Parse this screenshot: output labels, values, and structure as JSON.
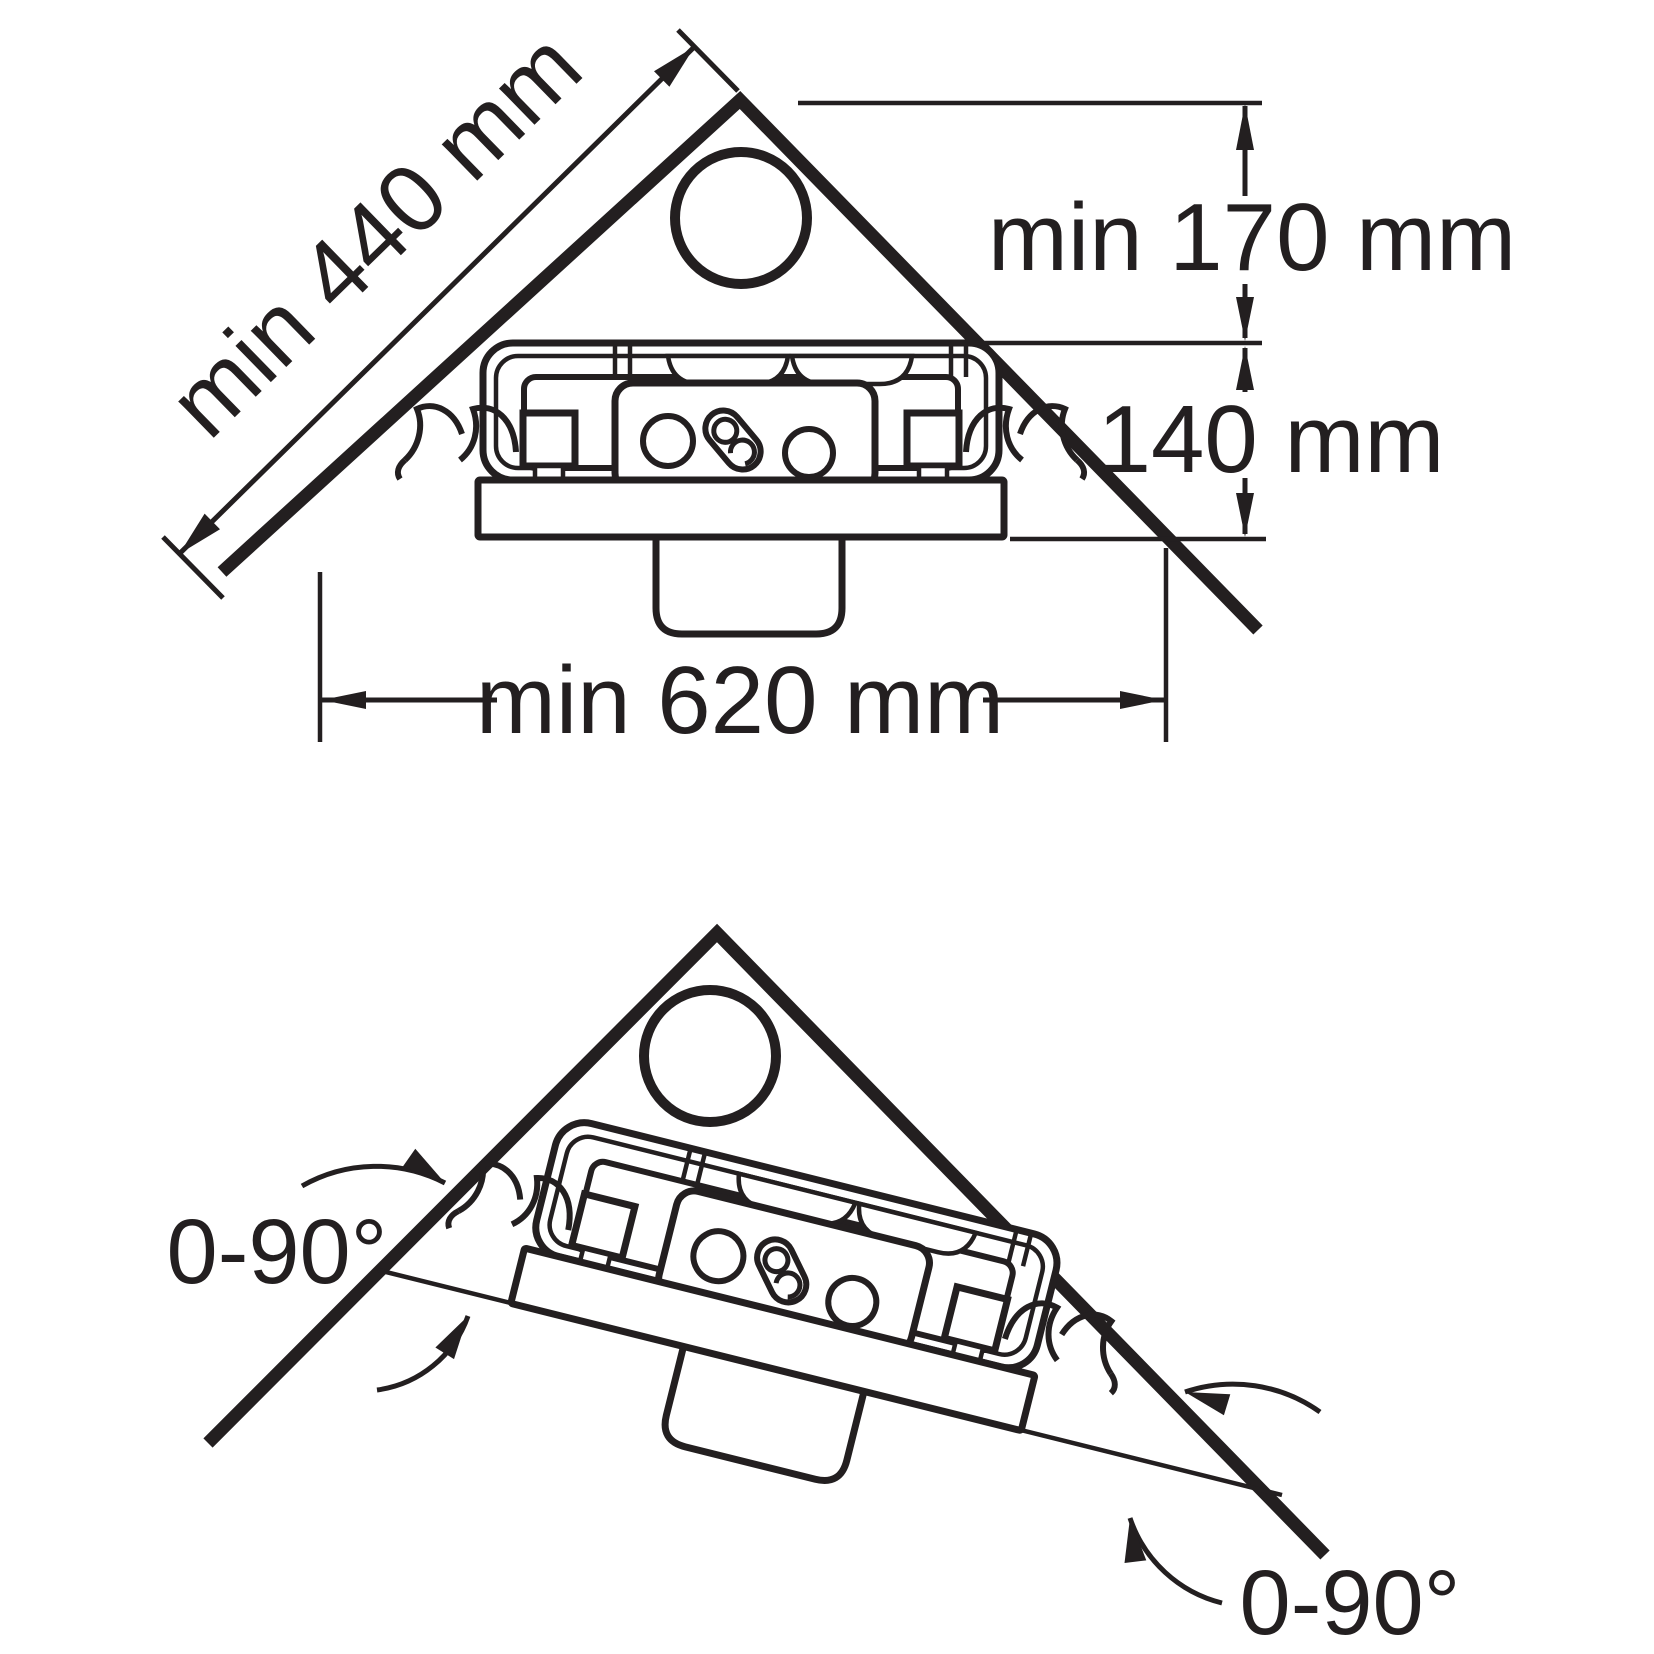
{
  "figure": {
    "type": "technical-installation-diagram",
    "views": {
      "top": "corner installation with minimum clearances",
      "bottom": "corner installation allowed rotation range"
    }
  },
  "labels": {
    "diagonal_clearance": "min 440 mm",
    "top_clearance": "min 170 mm",
    "unit_height": "140 mm",
    "width_clearance": "min 620 mm",
    "rotation_left": "0-90°",
    "rotation_right": "0-90°"
  },
  "colors": {
    "ink": "#231f20",
    "background": "#ffffff"
  }
}
